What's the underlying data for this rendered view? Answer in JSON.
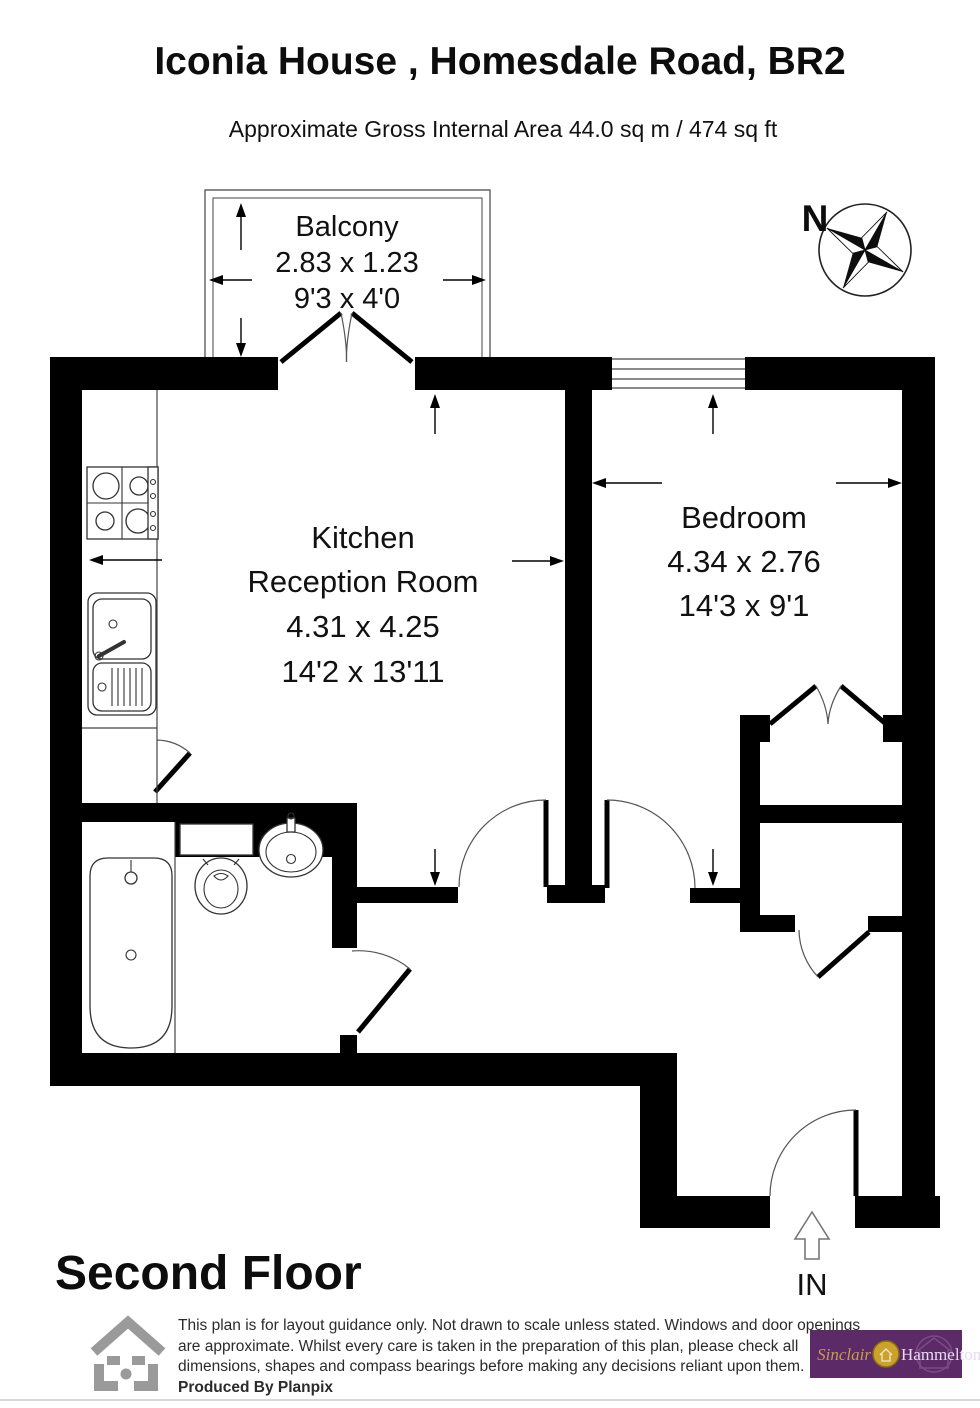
{
  "header": {
    "title": "Iconia House , Homesdale Road, BR2",
    "subtitle": "Approximate Gross Internal Area 44.0 sq m / 474 sq ft"
  },
  "rooms": {
    "balcony": {
      "name": "Balcony",
      "size_m": "2.83 x 1.23",
      "size_ft": "9'3 x 4'0"
    },
    "kitchen": {
      "name_line1": "Kitchen",
      "name_line2": "Reception Room",
      "size_m": "4.31 x 4.25",
      "size_ft": "14'2 x 13'11"
    },
    "bedroom": {
      "name": "Bedroom",
      "size_m": "4.34 x 2.76",
      "size_ft": "14'3 x 9'1"
    }
  },
  "floor_label": "Second Floor",
  "compass": {
    "north_label": "N"
  },
  "entrance": {
    "label": "IN"
  },
  "footer": {
    "disclaimer_line1": "This plan is for layout guidance only. Not drawn to scale unless stated. Windows and door openings",
    "disclaimer_line2": "are approximate. Whilst every care is taken in the preparation of this plan, please check all",
    "disclaimer_line3": "dimensions, shapes and compass bearings before making any decisions reliant upon them.",
    "credit": "Produced By Planpix",
    "agent_logo": {
      "part1": "Sinclair",
      "part2": "Hammelton"
    }
  },
  "colors": {
    "wall": "#000000",
    "logo_purple": "#5c2a66",
    "logo_gold": "#caa22d",
    "planpix_gray": "#9a9a9a"
  }
}
